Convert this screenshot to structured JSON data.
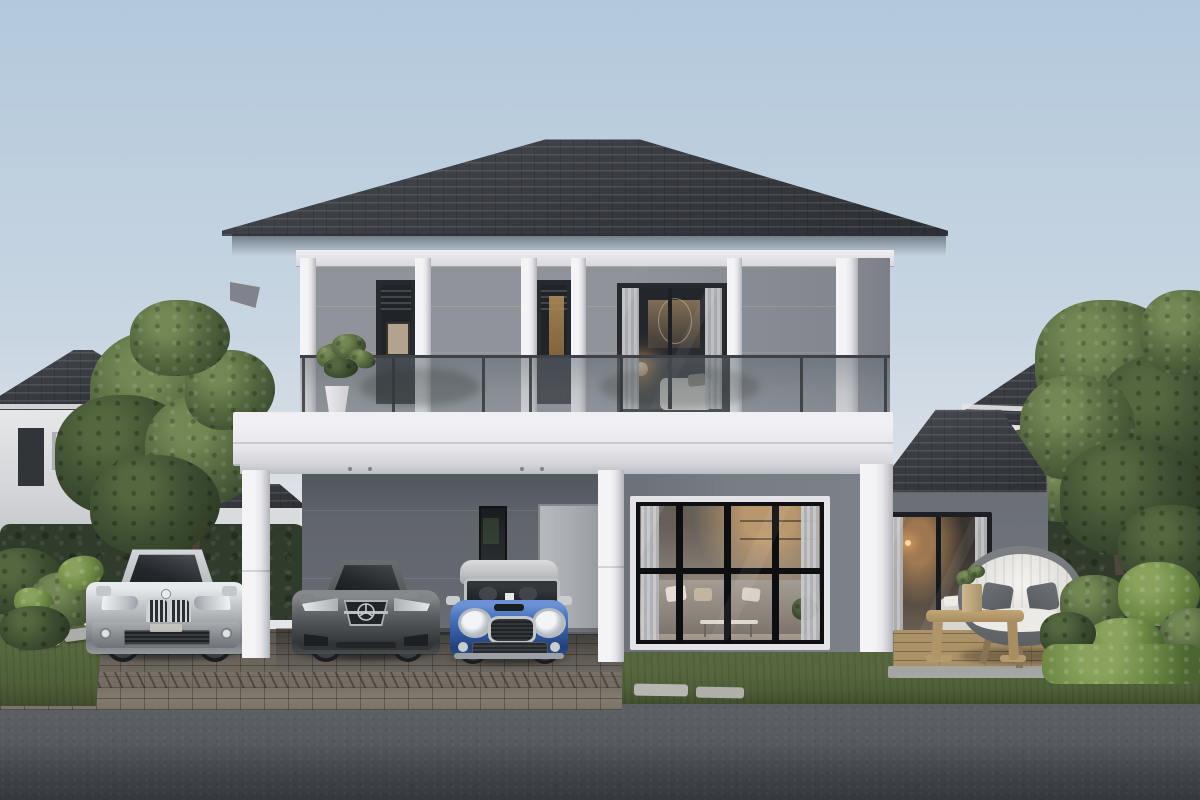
{
  "scene": {
    "type": "3d-architectural-exterior-render",
    "description": "Photorealistic dusk rendering of a modern two-storey grey house with hip roof, glass-railed balcony, carport with three parked cars (silver SUV, graphite sedan, blue mini hatchback), warm-lit interiors, timber patio deck with rattan lounge chair, hedges, trees and neighbouring houses along a street.",
    "time_of_day": "dusk",
    "objects": [
      "dusk sky",
      "hip tiled roof",
      "upper floor balcony with glass railing",
      "potted balcony plant",
      "warm-lit bedroom sliding door",
      "two narrow louvred windows",
      "white floor slab band",
      "carport with white columns",
      "recessed ceiling downlights",
      "entry door",
      "narrow side window",
      "floor-to-ceiling living room window with curtains",
      "single-storey bedroom wing with tiled roof",
      "bedroom picture window",
      "timber patio deck",
      "round rattan lounge chair with cushions",
      "bentwood coffee table with planter",
      "silver SUV",
      "graphite sedan",
      "blue mini hatchback",
      "brick paver driveway",
      "stepping stones",
      "lawn strips",
      "trimmed hedges",
      "tropical shrubs",
      "neighbour house left",
      "neighbour house right",
      "distant house",
      "street curb",
      "asphalt road"
    ],
    "counts": {
      "cars": 3,
      "balcony_plants": 1,
      "patio_chairs": 1
    }
  },
  "palette": {
    "sky_top": "#b2c8db",
    "sky_mid": "#c9d6e2",
    "sky_horizon": "#e2e5e8",
    "roof": "#3a3d42",
    "roof_light": "#4b4f55",
    "wall_upper": "#8e9298",
    "wall_carport": "#64696f",
    "wall_lit": "#7c8188",
    "wall_annex": "#6f747a",
    "trim": "#efeef2",
    "trim_shade": "#c5c5cc",
    "band": "#e6e5ea",
    "glass": "#1f2226",
    "frame": "#26292e",
    "warm_glow": "#ffbe78",
    "warm_wood": "#ad8a56",
    "curtain": "#c7c8cc",
    "hedge": "#2f3c2b",
    "hedge_dark": "#243020",
    "foliage": "#55673f",
    "foliage_dark": "#3c4c30",
    "foliage_light": "#738753",
    "grass": "#4f6039",
    "plant_bright": "#6e8a45",
    "paver": "#6e6860",
    "paver_joint": "#4e4a43",
    "curb": "#8a8b88",
    "road": "#55595d",
    "road_dark": "#35383c",
    "deck": "#a18a62",
    "concrete": "#a5a5a1",
    "stone": "#acaca8",
    "car_silver": "#c0c4c8",
    "car_graphite": "#54575a",
    "car_blue": "#3a64ad",
    "wheel": "#1a1c1e",
    "door_gray": "#a6aaaf"
  }
}
